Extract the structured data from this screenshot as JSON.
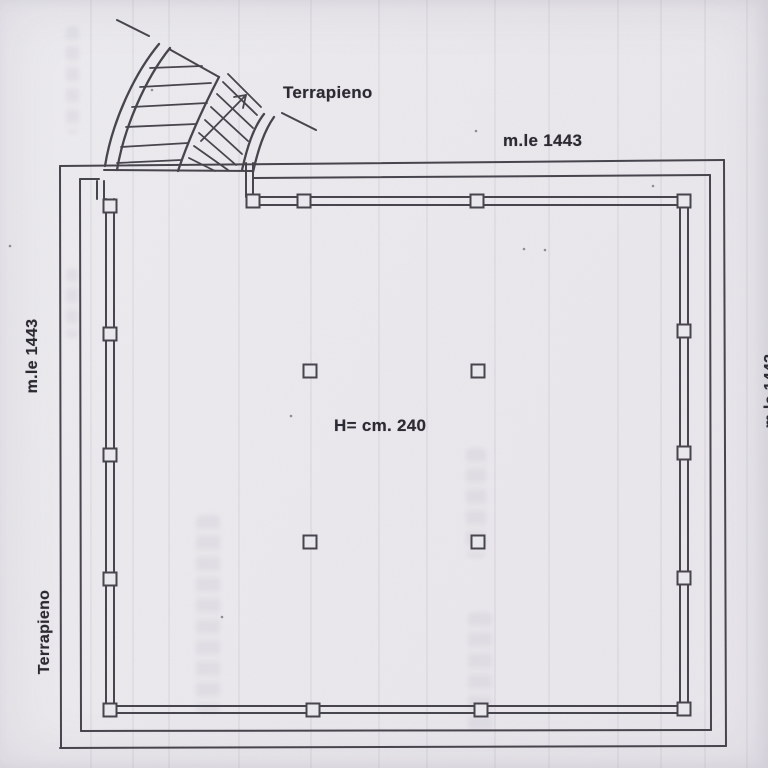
{
  "labels": {
    "terrapieno_top": "Terrapieno",
    "mle_top": "m.le 1443",
    "mle_left": "m.le 1443",
    "terrapieno_left": "Terrapieno",
    "height_note": "H= cm. 240",
    "mle_right_clipped": "m.le 1443"
  },
  "colors": {
    "paper": "#eae9ed",
    "ink": "#44424a",
    "label_ink": "#2c2b33"
  },
  "plan": {
    "stroke_width": 2,
    "segments": [
      [
        60,
        166,
        724,
        160
      ],
      [
        80,
        179,
        99,
        179
      ],
      [
        253,
        178,
        710,
        175
      ],
      [
        724,
        160,
        726,
        746
      ],
      [
        710,
        175,
        711,
        730
      ],
      [
        60,
        748,
        726,
        746
      ],
      [
        81,
        731,
        711,
        730
      ],
      [
        60,
        166,
        61,
        748
      ],
      [
        80,
        179,
        81,
        731
      ],
      [
        97,
        181,
        97,
        199
      ],
      [
        104,
        181,
        104,
        199
      ],
      [
        246,
        163,
        246,
        197
      ],
      [
        253,
        163,
        253,
        197
      ],
      [
        250,
        197,
        687,
        197
      ],
      [
        250,
        205,
        687,
        205
      ],
      [
        680,
        197,
        680,
        712
      ],
      [
        688,
        197,
        688,
        712
      ],
      [
        106,
        706,
        688,
        706
      ],
      [
        106,
        713,
        688,
        713
      ],
      [
        106,
        199,
        106,
        713
      ],
      [
        114,
        199,
        114,
        713
      ],
      [
        104,
        170,
        252,
        171
      ]
    ],
    "arc_paths": [
      "M 105,166 C 112,122 134,74 159,44",
      "M 117,170 C 124,128 145,79 170,48",
      "M 219,77 C 206,102 190,135 178,171",
      "M 242,170 C 247,148 253,128 264,114",
      "M 253,172 C 258,150 264,131 274,117"
    ],
    "fan_edges": [
      [
        117,
        20,
        149,
        36
      ],
      [
        169,
        49,
        219,
        77
      ],
      [
        282,
        113,
        316,
        130
      ]
    ],
    "hatch_left": [
      [
        150,
        68,
        202,
        66
      ],
      [
        140,
        87,
        211,
        83
      ],
      [
        132,
        107,
        207,
        103
      ],
      [
        126,
        127,
        196,
        124
      ],
      [
        121,
        147,
        188,
        143
      ],
      [
        117,
        163,
        181,
        160
      ]
    ],
    "hatch_right": [
      [
        228,
        74,
        261,
        107
      ],
      [
        223,
        82,
        257,
        115
      ],
      [
        217,
        94,
        253,
        128
      ],
      [
        211,
        107,
        248,
        141
      ],
      [
        205,
        120,
        242,
        154
      ],
      [
        199,
        133,
        236,
        165
      ],
      [
        194,
        146,
        228,
        170
      ],
      [
        189,
        158,
        215,
        171
      ]
    ],
    "arrow": {
      "shaft": [
        201,
        141,
        246,
        95
      ],
      "barb1": [
        246,
        95,
        234,
        97
      ],
      "barb2": [
        246,
        95,
        243,
        108
      ]
    },
    "pillar_size": 13,
    "pillars": [
      [
        110,
        206
      ],
      [
        110,
        334
      ],
      [
        110,
        455
      ],
      [
        110,
        579
      ],
      [
        110,
        710
      ],
      [
        253,
        201
      ],
      [
        304,
        201
      ],
      [
        477,
        201
      ],
      [
        684,
        201
      ],
      [
        684,
        331
      ],
      [
        684,
        453
      ],
      [
        684,
        578
      ],
      [
        684,
        709
      ],
      [
        313,
        710
      ],
      [
        481,
        710
      ],
      [
        310,
        371
      ],
      [
        478,
        371
      ],
      [
        310,
        542
      ],
      [
        478,
        542
      ]
    ],
    "specks": [
      [
        10,
        246
      ],
      [
        152,
        90
      ],
      [
        476,
        131
      ],
      [
        524,
        249
      ],
      [
        545,
        250
      ],
      [
        653,
        186
      ],
      [
        222,
        617
      ],
      [
        291,
        416
      ]
    ],
    "streaks_x": [
      90,
      132,
      168,
      238,
      310,
      378,
      426,
      494,
      548,
      617,
      660,
      704,
      746
    ],
    "smudges": [
      {
        "x": 196,
        "y": 515,
        "w": 24,
        "h": 198
      },
      {
        "x": 466,
        "y": 448,
        "w": 20,
        "h": 110
      },
      {
        "x": 468,
        "y": 612,
        "w": 24,
        "h": 118
      },
      {
        "x": 66,
        "y": 26,
        "w": 13,
        "h": 108
      },
      {
        "x": 66,
        "y": 268,
        "w": 12,
        "h": 70
      }
    ]
  }
}
